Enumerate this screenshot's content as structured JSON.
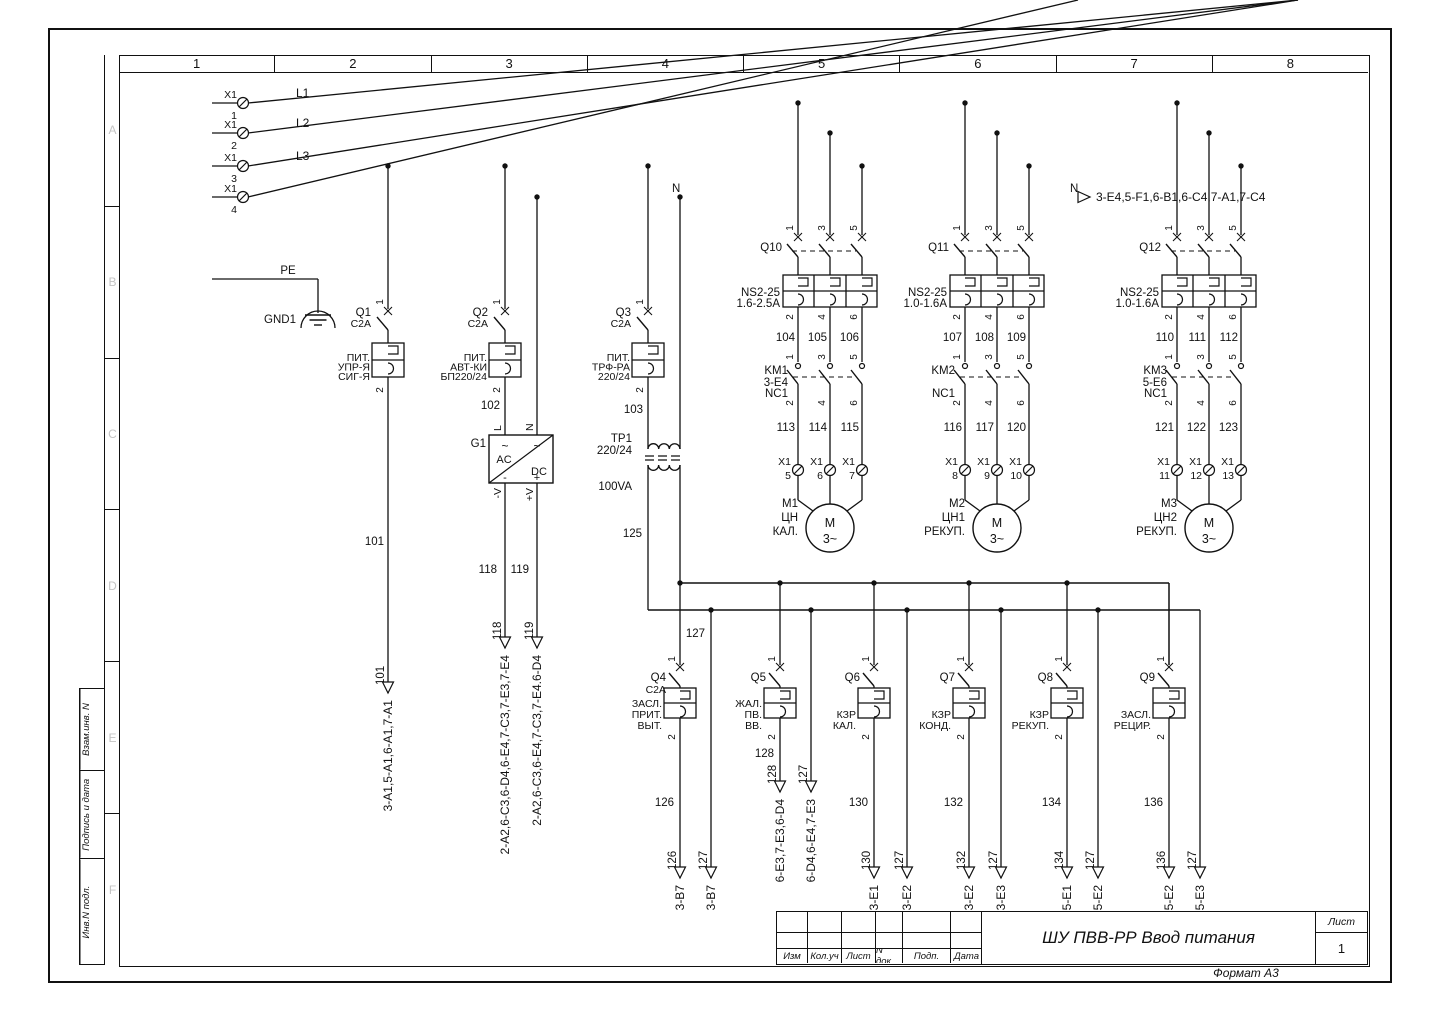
{
  "frame": {
    "column_numbers": [
      "1",
      "2",
      "3",
      "4",
      "5",
      "6",
      "7",
      "8"
    ],
    "row_letters": [
      "A",
      "B",
      "C",
      "D",
      "E",
      "F"
    ],
    "side_stamps": [
      "Взам.инв. N",
      "Подпись и дата",
      "Инв.N подл."
    ],
    "title_block": {
      "revision_columns": [
        "Изм",
        "Кол.уч",
        "Лист",
        "N док.",
        "Подп.",
        "Дата"
      ],
      "title": "ШУ ПВВ-РР Ввод питания",
      "sheet_label": "Лист",
      "sheet_number": "1",
      "format": "Формат А3"
    }
  },
  "schematic": {
    "terminal_block": "X1",
    "pole_terms_in": [
      "1",
      "3",
      "5"
    ],
    "pole_terms_out": [
      "2",
      "4",
      "6"
    ],
    "breaker_terms": [
      "1",
      "2"
    ],
    "power_buses": [
      {
        "label": "L1",
        "terminal": "1"
      },
      {
        "label": "L2",
        "terminal": "2"
      },
      {
        "label": "L3",
        "terminal": "3"
      },
      {
        "label": "",
        "terminal": "4"
      }
    ],
    "neutral": {
      "label": "N",
      "ref_dest": "3-E4,5-F1,6-B1,6-C4,7-A1,7-C4"
    },
    "earth": {
      "pe_label": "PE",
      "gnd_label": "GND1"
    },
    "feeders": [
      {
        "ref": "Q1",
        "rating": "C2A",
        "desc": [
          "ПИТ.",
          "УПР-Я",
          "СИГ-Я"
        ],
        "wire": "101",
        "dest": "3-A1,5-A1,6-A1,7-A1"
      },
      {
        "ref": "Q2",
        "rating": "C2A",
        "desc": [
          "ПИТ.",
          "АВТ-КИ",
          "БП220/24"
        ],
        "wire": "102"
      },
      {
        "ref": "Q3",
        "rating": "C2A",
        "desc": [
          "ПИТ.",
          "ТРФ-РА",
          "220/24"
        ],
        "wire": "103"
      }
    ],
    "psu": {
      "ref": "G1",
      "ac": "AC",
      "dc": "DC",
      "tilde": "~",
      "minus": "-",
      "plus": "+",
      "in_labels": [
        "L",
        "N"
      ],
      "out_labels": [
        "-V",
        "+V"
      ],
      "outputs": [
        {
          "wire": "118",
          "dest": "2-A2,6-C3,6-D4,6-E4,7-C3,7-E3,7-E4"
        },
        {
          "wire": "119",
          "dest": "2-A2,6-C3,6-E4,7-C3,7-E4.6-D4"
        }
      ]
    },
    "transformer": {
      "ref": "ТР1",
      "ratio": "220/24",
      "power": "100VA",
      "sec_wire": "125"
    },
    "motor_groups": [
      {
        "breaker": "Q10",
        "device": "NS2-25",
        "range": "1.6-2.5А",
        "wires_upper": [
          "104",
          "105",
          "106"
        ],
        "contactor": [
          "KM1",
          "3-E4",
          "NC1"
        ],
        "wires_lower": [
          "113",
          "114",
          "115"
        ],
        "x1_terms": [
          "5",
          "6",
          "7"
        ],
        "motor_ref": "M1",
        "motor_desc": [
          "ЦН",
          "КАЛ."
        ],
        "motor_sym": [
          "M",
          "3~"
        ]
      },
      {
        "breaker": "Q11",
        "device": "NS2-25",
        "range": "1.0-1.6А",
        "wires_upper": [
          "107",
          "108",
          "109"
        ],
        "contactor": [
          "KM2",
          "NC1"
        ],
        "wires_lower": [
          "116",
          "117",
          "120"
        ],
        "x1_terms": [
          "8",
          "9",
          "10"
        ],
        "motor_ref": "M2",
        "motor_desc": [
          "ЦН1",
          "РЕКУП."
        ],
        "motor_sym": [
          "M",
          "3~"
        ]
      },
      {
        "breaker": "Q12",
        "device": "NS2-25",
        "range": "1.0-1.6А",
        "wires_upper": [
          "110",
          "111",
          "112"
        ],
        "contactor": [
          "KM3",
          "5-E6",
          "NC1"
        ],
        "wires_lower": [
          "121",
          "122",
          "123"
        ],
        "x1_terms": [
          "11",
          "12",
          "13"
        ],
        "motor_ref": "M3",
        "motor_desc": [
          "ЦН2",
          "РЕКУП."
        ],
        "motor_sym": [
          "M",
          "3~"
        ]
      }
    ],
    "dist_bus_wire": "127",
    "dist_breakers": [
      {
        "ref": "Q4",
        "rating": "C2A",
        "desc": [
          "ЗАСЛ.",
          "ПРИТ.",
          "ВЫТ."
        ],
        "wire": "126",
        "dest": "3-B7",
        "aux_dest": "3-B7"
      },
      {
        "ref": "Q5",
        "desc": [
          "ЖАЛ.",
          "ПВ.",
          "ВВ."
        ],
        "wire": "128",
        "dest": "6-E3,7-E3,6-D4",
        "aux_dest": "6-D4,6-E4,7-E3"
      },
      {
        "ref": "Q6",
        "desc": [
          "КЗР",
          "КАЛ."
        ],
        "wire": "130",
        "dest": "3-E1",
        "aux_dest": "3-E2"
      },
      {
        "ref": "Q7",
        "desc": [
          "КЗР",
          "КОНД."
        ],
        "wire": "132",
        "dest": "3-E2",
        "aux_dest": "3-E3"
      },
      {
        "ref": "Q8",
        "desc": [
          "КЗР",
          "РЕКУП."
        ],
        "wire": "134",
        "dest": "5-E1",
        "aux_dest": "5-E2"
      },
      {
        "ref": "Q9",
        "desc": [
          "ЗАСЛ.",
          "РЕЦИР."
        ],
        "wire": "136",
        "dest": "5-E2",
        "aux_dest": "5-E3"
      }
    ]
  }
}
